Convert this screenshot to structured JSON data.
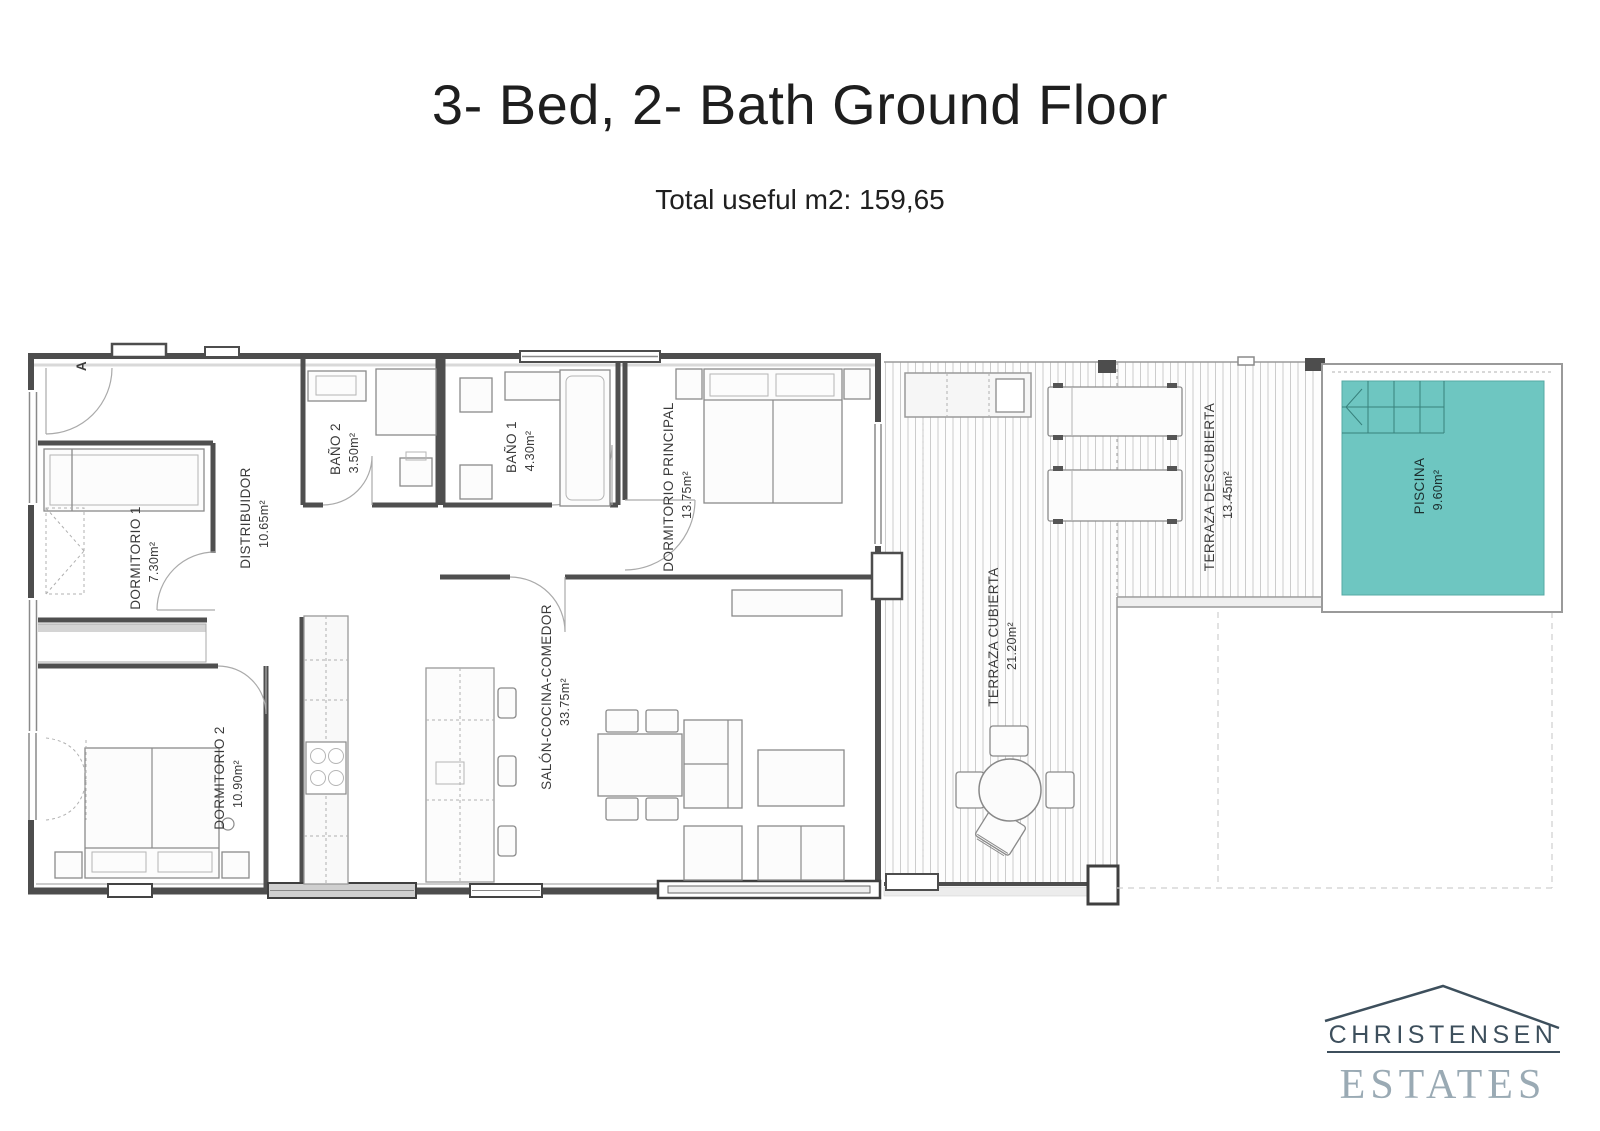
{
  "page": {
    "title": "3- Bed, 2- Bath Ground Floor",
    "subtitle": "Total useful m2: 159,65"
  },
  "plan": {
    "entrance_marker": "A",
    "rooms": {
      "dormitorio1": {
        "name": "DORMITORIO 1",
        "area": "7.30m²"
      },
      "distribuidor": {
        "name": "DISTRIBUIDOR",
        "area": "10.65m²"
      },
      "bano2": {
        "name": "BAÑO 2",
        "area": "3.50m²"
      },
      "bano1": {
        "name": "BAÑO 1",
        "area": "4.30m²"
      },
      "dormitorio_principal": {
        "name": "DORMITORIO PRINCIPAL",
        "area": "13.75m²"
      },
      "dormitorio2": {
        "name": "DORMITORIO 2",
        "area": "10.90m²"
      },
      "salon": {
        "name": "SALÓN-COCINA-COMEDOR",
        "area": "33.75m²"
      },
      "terraza_cubierta": {
        "name": "TERRAZA CUBIERTA",
        "area": "21.20m²"
      },
      "terraza_descubierta": {
        "name": "TERRAZA DESCUBIERTA",
        "area": "13.45m²"
      },
      "piscina": {
        "name": "PISCINA",
        "area": "9.60m²"
      }
    },
    "colors": {
      "pool": "#6ec6c1",
      "walls": "#4d4d4d"
    }
  },
  "logo": {
    "name": "CHRISTENSEN",
    "type": "ESTATES",
    "color_dark": "#3d4f5c",
    "color_light": "#9aaab4"
  }
}
